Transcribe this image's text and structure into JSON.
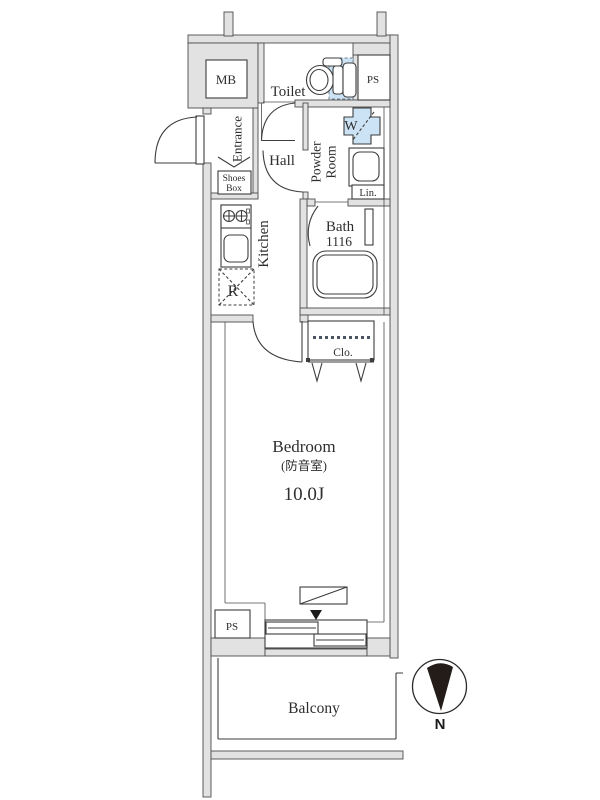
{
  "title": "apartment-floor-plan",
  "colors": {
    "wall_fill": "#e2e2e2",
    "wall_stroke": "#4d4d4d",
    "line": "#3d3d3d",
    "fixture_blue": "#cbe3f4",
    "text": "#2e2e2e",
    "marker_black": "#1c1c1c"
  },
  "rooms": {
    "mb": {
      "label": "MB"
    },
    "toilet": {
      "label": "Toilet"
    },
    "ps_upper": {
      "label": "PS"
    },
    "entrance": {
      "label": "Entrance"
    },
    "shoes_box": {
      "line1": "Shoes",
      "line2": "Box"
    },
    "hall": {
      "label": "Hall"
    },
    "powder_room": {
      "line1": "Powder",
      "line2": "Room"
    },
    "washer": {
      "label": "W"
    },
    "linen": {
      "label": "Lin."
    },
    "kitchen": {
      "label": "Kitchen"
    },
    "bath": {
      "name": "Bath",
      "size": "1116"
    },
    "refrigerator": {
      "label": "R"
    },
    "closet": {
      "label": "Clo."
    },
    "bedroom": {
      "name": "Bedroom",
      "note": "(防音室)",
      "size": "10.0J"
    },
    "ps_lower": {
      "label": "PS"
    },
    "balcony": {
      "label": "Balcony"
    }
  },
  "compass": {
    "north": "N"
  },
  "fixtures": [
    "toilet-icon",
    "washing-machine-pan-icon",
    "washbasin-icon",
    "bathtub-icon",
    "gas-stove-icon",
    "kitchen-sink-icon",
    "refrigerator-space-icon",
    "closet-hanger-rail",
    "sliding-window",
    "folding-door",
    "north-arrow-icon"
  ]
}
